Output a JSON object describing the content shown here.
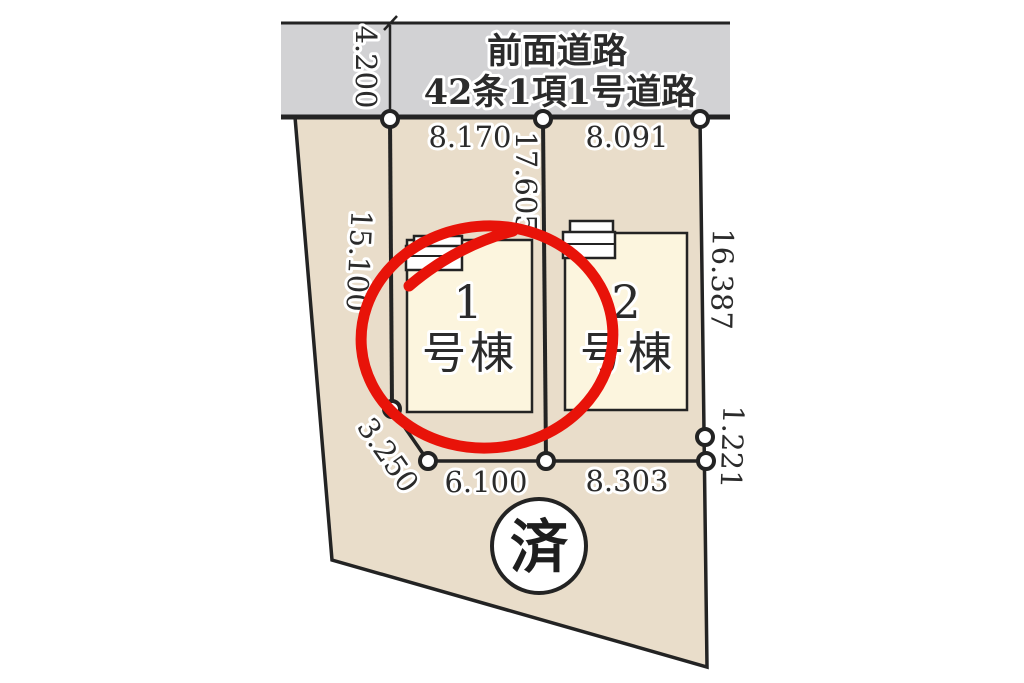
{
  "road": {
    "label_line1": "前面道路",
    "label_line2": "42条1項1号道路"
  },
  "dimensions": {
    "road_width": "4.200",
    "frontage_lot1": "8.170",
    "frontage_lot2": "8.091",
    "center_divider": "17.605",
    "left_side": "15.100",
    "right_side_upper": "16.387",
    "right_side_lower": "1.221",
    "bottom_diagonal": "3.250",
    "bottom_lot1": "6.100",
    "bottom_lot2": "8.303"
  },
  "buildings": [
    {
      "number": "1",
      "suffix": "号棟"
    },
    {
      "number": "2",
      "suffix": "号棟"
    }
  ],
  "stamp": {
    "label": "済"
  },
  "colors": {
    "line": "#232323",
    "text": "#2b2b2b",
    "road_fill": "#d2d2d4",
    "parcel_fill": "#e9ddca",
    "building_fill": "#fcf5de",
    "accent_red": "#e81309",
    "stamp_bg": "#ffffff",
    "page_bg": "#ffffff"
  }
}
